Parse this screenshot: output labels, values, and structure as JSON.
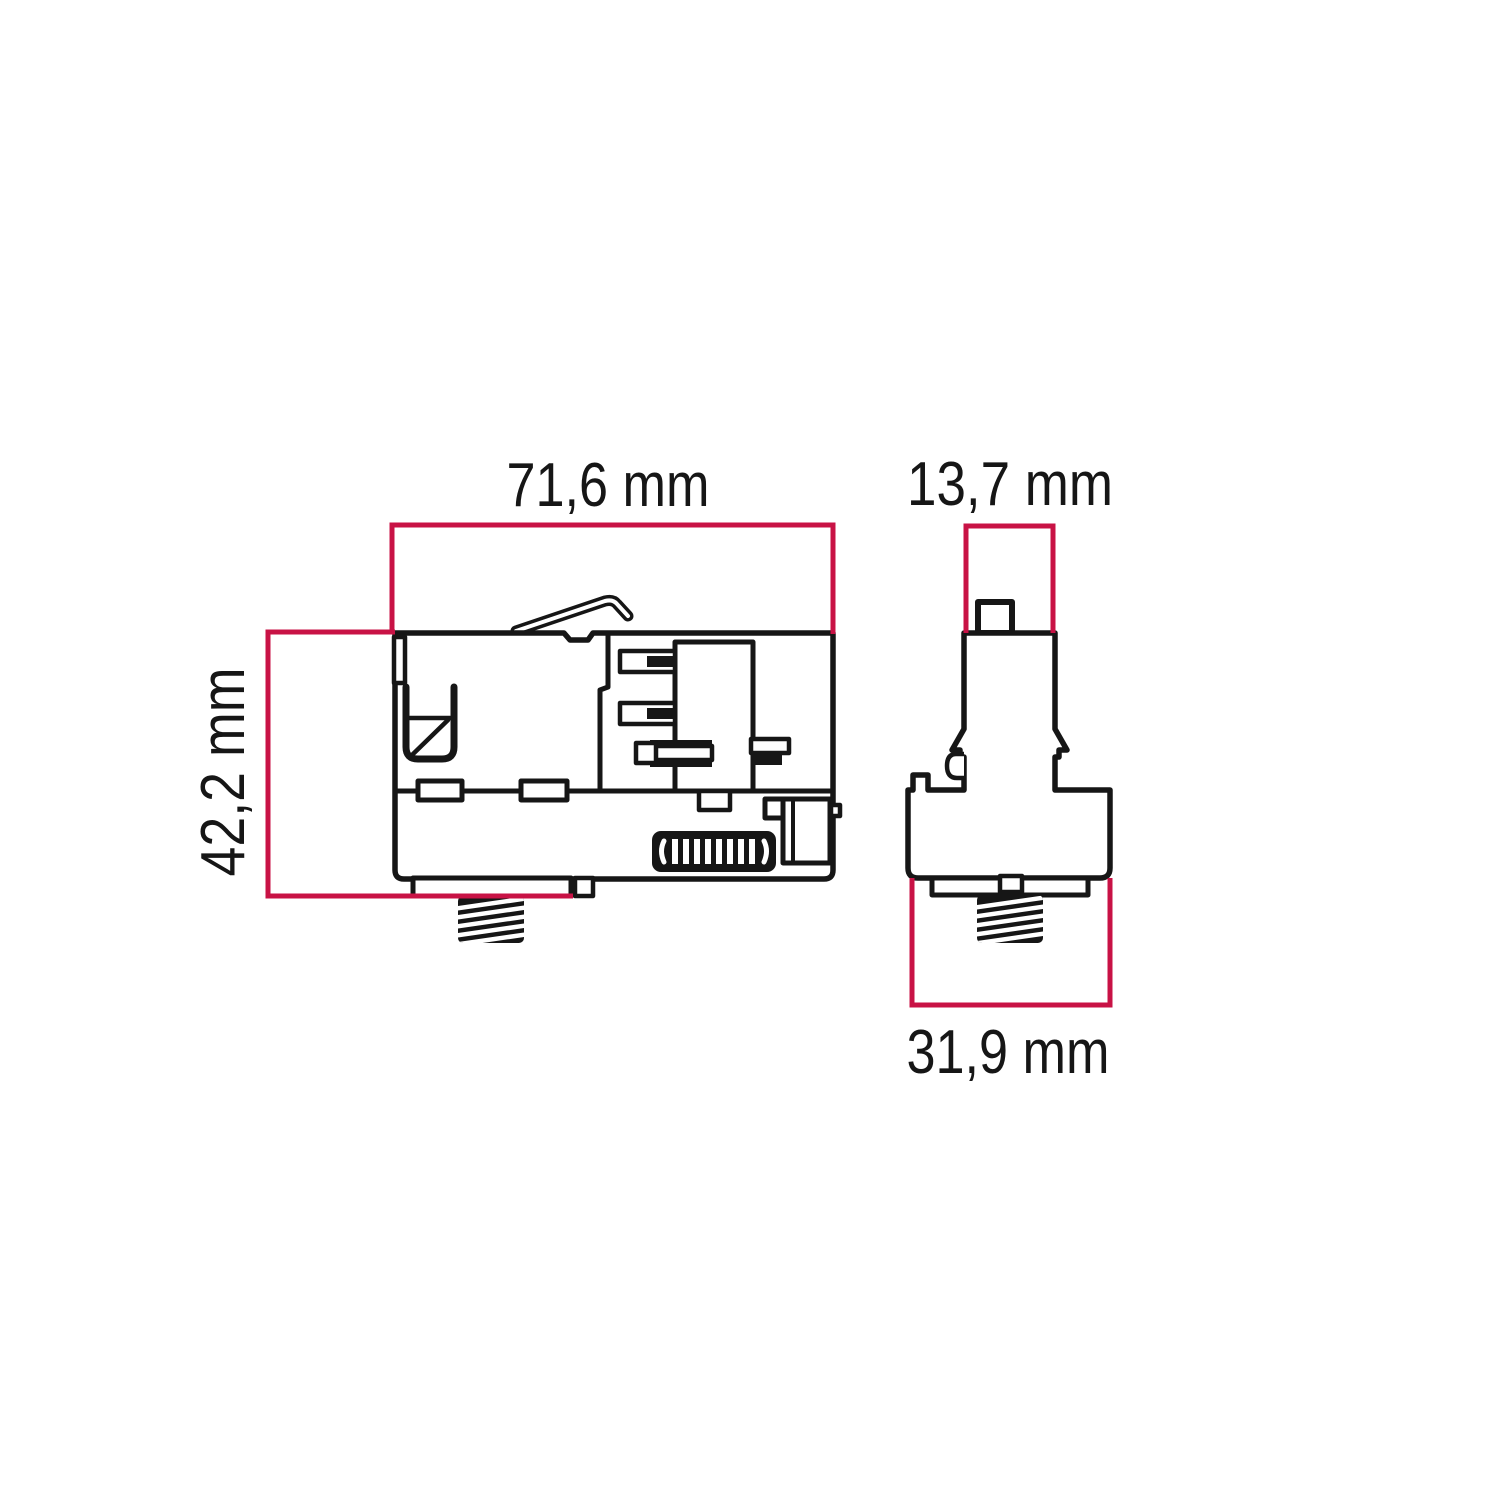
{
  "figure": {
    "type": "technical dimension drawing",
    "subject": "track adapter, side and front orthographic views",
    "units": "mm",
    "views": {
      "side_view": {
        "width": {
          "label": "71,6 mm",
          "value": 71.6,
          "unit": "mm"
        },
        "height": {
          "label": "42,2 mm",
          "value": 42.2,
          "unit": "mm"
        }
      },
      "front_view": {
        "top_width": {
          "label": "13,7 mm",
          "value": 13.7,
          "unit": "mm"
        },
        "body_width": {
          "label": "31,9 mm",
          "value": 31.9,
          "unit": "mm"
        }
      }
    },
    "colors": {
      "dimension_line": "#c81245",
      "drawing_ink": "#161616",
      "background": "#ffffff"
    }
  }
}
